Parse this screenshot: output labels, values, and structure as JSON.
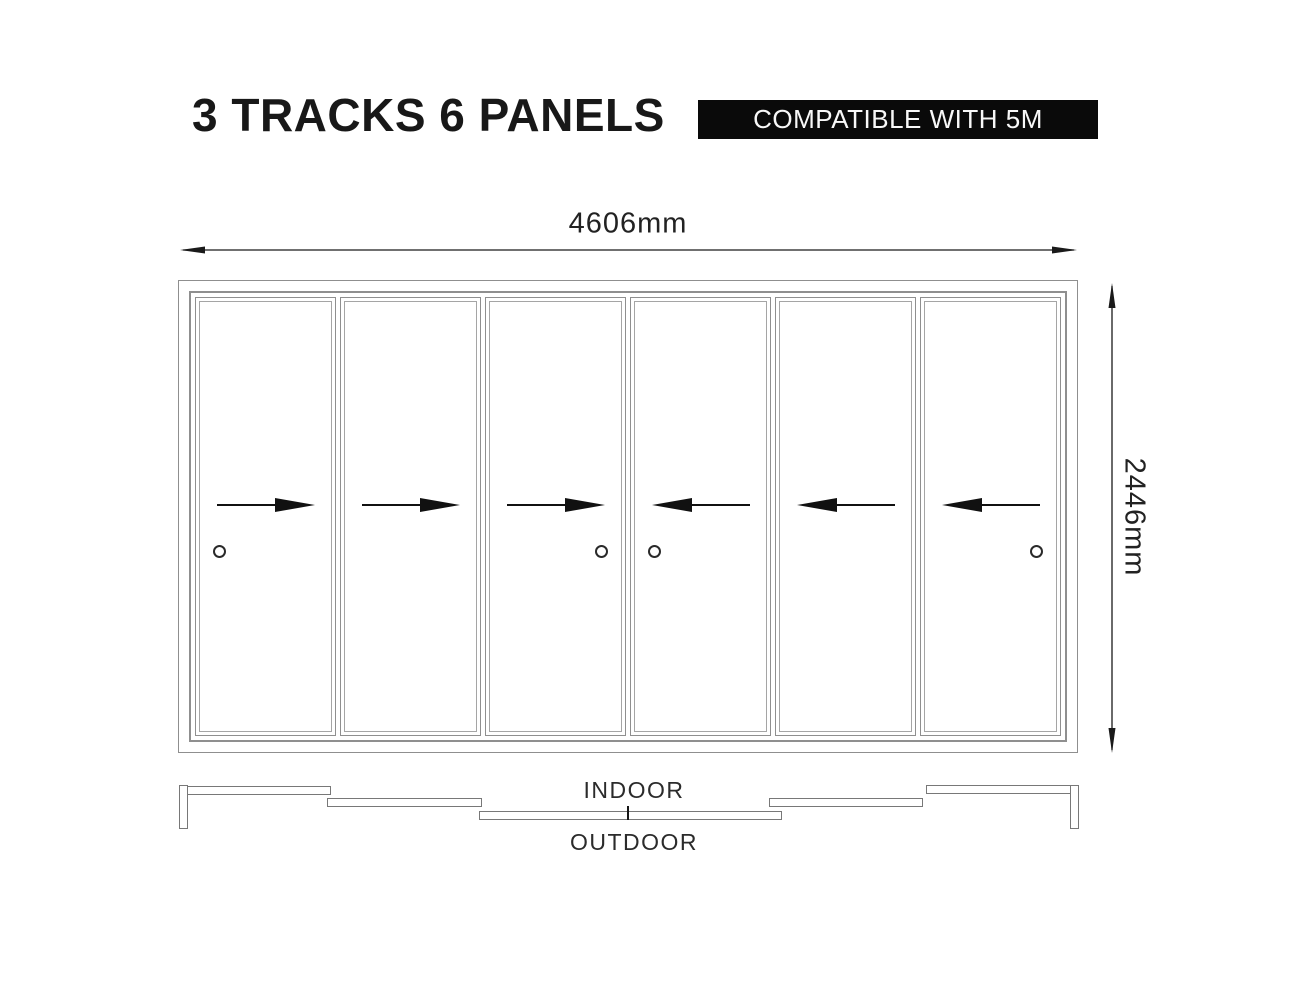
{
  "header": {
    "title": "3 TRACKS 6 PANELS",
    "badge": "COMPATIBLE WITH 5M"
  },
  "dimensions": {
    "width_label": "4606mm",
    "height_label": "2446mm"
  },
  "diagram": {
    "track_count": 3,
    "panel_count": 6,
    "panels": [
      {
        "slide": "right",
        "handle": "left"
      },
      {
        "slide": "right",
        "handle": "none"
      },
      {
        "slide": "right",
        "handle": "right"
      },
      {
        "slide": "left",
        "handle": "left"
      },
      {
        "slide": "left",
        "handle": "none"
      },
      {
        "slide": "left",
        "handle": "right"
      }
    ]
  },
  "plan": {
    "indoor_label": "INDOOR",
    "outdoor_label": "OUTDOOR"
  },
  "colors": {
    "frame_line": "#8f8f8f",
    "accent": "#111111",
    "badge_bg": "#0a0a0a",
    "badge_text": "#f8f8f8"
  }
}
